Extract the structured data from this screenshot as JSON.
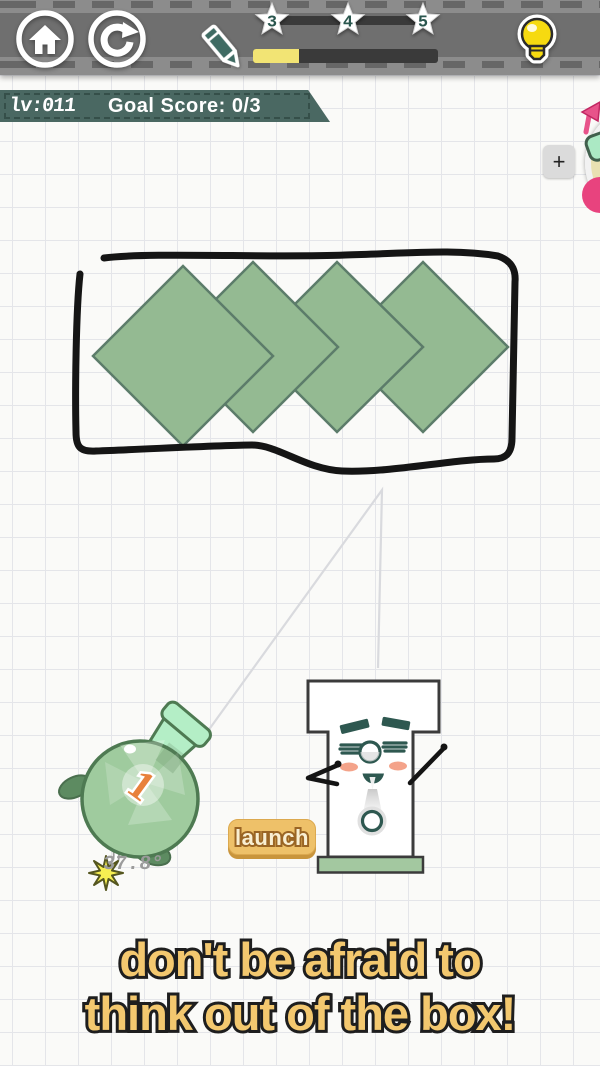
{
  "topbar": {
    "icons": {
      "home": "home-icon",
      "restart": "restart-icon",
      "pencil": "pencil-icon",
      "hint": "lightbulb-icon"
    },
    "stars": [
      {
        "label": "3"
      },
      {
        "label": "4"
      },
      {
        "label": "5"
      }
    ],
    "progress_percent": 25
  },
  "level_banner": {
    "level": "lv:011",
    "goal": "Goal Score: 0/3"
  },
  "side_panel": {
    "add_button": "+",
    "wheel_icon": "item-wheel-icon"
  },
  "game": {
    "angle": "37.8°",
    "launch_button": "launch",
    "bomb_number": "1",
    "diamond_fill": "#94ba92",
    "diamond_stroke": "#5c7c6a",
    "diamonds": [
      {
        "points": "183,266 273,356 183,446 93,356"
      },
      {
        "points": "253,262 338,347 253,432 168,347"
      },
      {
        "points": "337,262 423,347 337,432 252,347"
      },
      {
        "points": "423,262 508,347 423,432 338,347"
      }
    ]
  },
  "hint_text": {
    "line1": "don't be afraid to",
    "line2": "think out of the box!"
  },
  "colors": {
    "bar_gray": "#8c8c8c",
    "band_gray": "#6f6f6f",
    "banner_teal": "#4a6862",
    "accent_yellow": "#f2e474",
    "hint_gold": "#f3c86f",
    "launch_bg": "#eec169",
    "wheel_pink": "#e8437e",
    "diamond_green": "#94ba92",
    "bomb_green": "#9fcb9e"
  }
}
